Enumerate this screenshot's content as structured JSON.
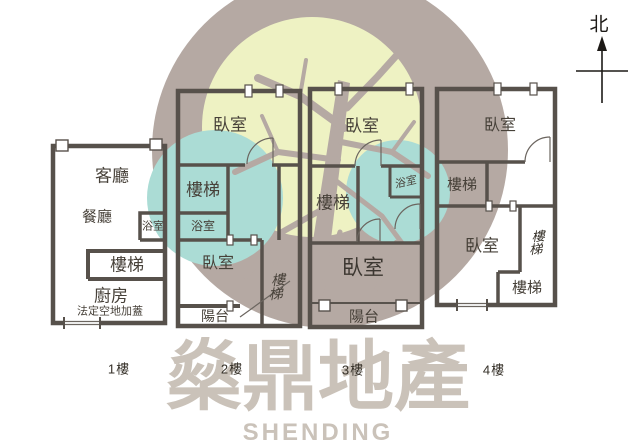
{
  "compass": {
    "north_label": "北"
  },
  "floors": {
    "f1": {
      "label": "1樓",
      "living": "客廳",
      "dining": "餐廳",
      "bath": "浴室",
      "stairs": "樓梯",
      "kitchen": "廚房",
      "annex": "法定空地加蓋"
    },
    "f2": {
      "label": "2樓",
      "bedroom_top": "臥室",
      "stairs": "樓梯",
      "bath": "浴室",
      "bedroom_bottom": "臥室",
      "stairs_side": "樓梯",
      "balcony": "陽台"
    },
    "f3": {
      "label": "3樓",
      "bedroom_top": "臥室",
      "stairs": "樓梯",
      "bath": "浴室",
      "bedroom_bottom": "臥室",
      "balcony": "陽台"
    },
    "f4": {
      "label": "4樓",
      "bedroom_top": "臥室",
      "stairs": "樓梯",
      "bedroom_bottom": "臥室",
      "stairs_side": "樓梯",
      "stairs_bottom": "樓梯"
    }
  },
  "watermark": {
    "brand": "燊鼎地產",
    "brand_en": "SHENDING"
  },
  "colors": {
    "wall": "#57514b",
    "label_text": "#474139",
    "logo_circle": "#b5a9a3",
    "logo_leaf": "#eef2c3",
    "logo_teal": "#abdcd5",
    "logo_text": "#cac2b9",
    "background": "#ffffff"
  }
}
